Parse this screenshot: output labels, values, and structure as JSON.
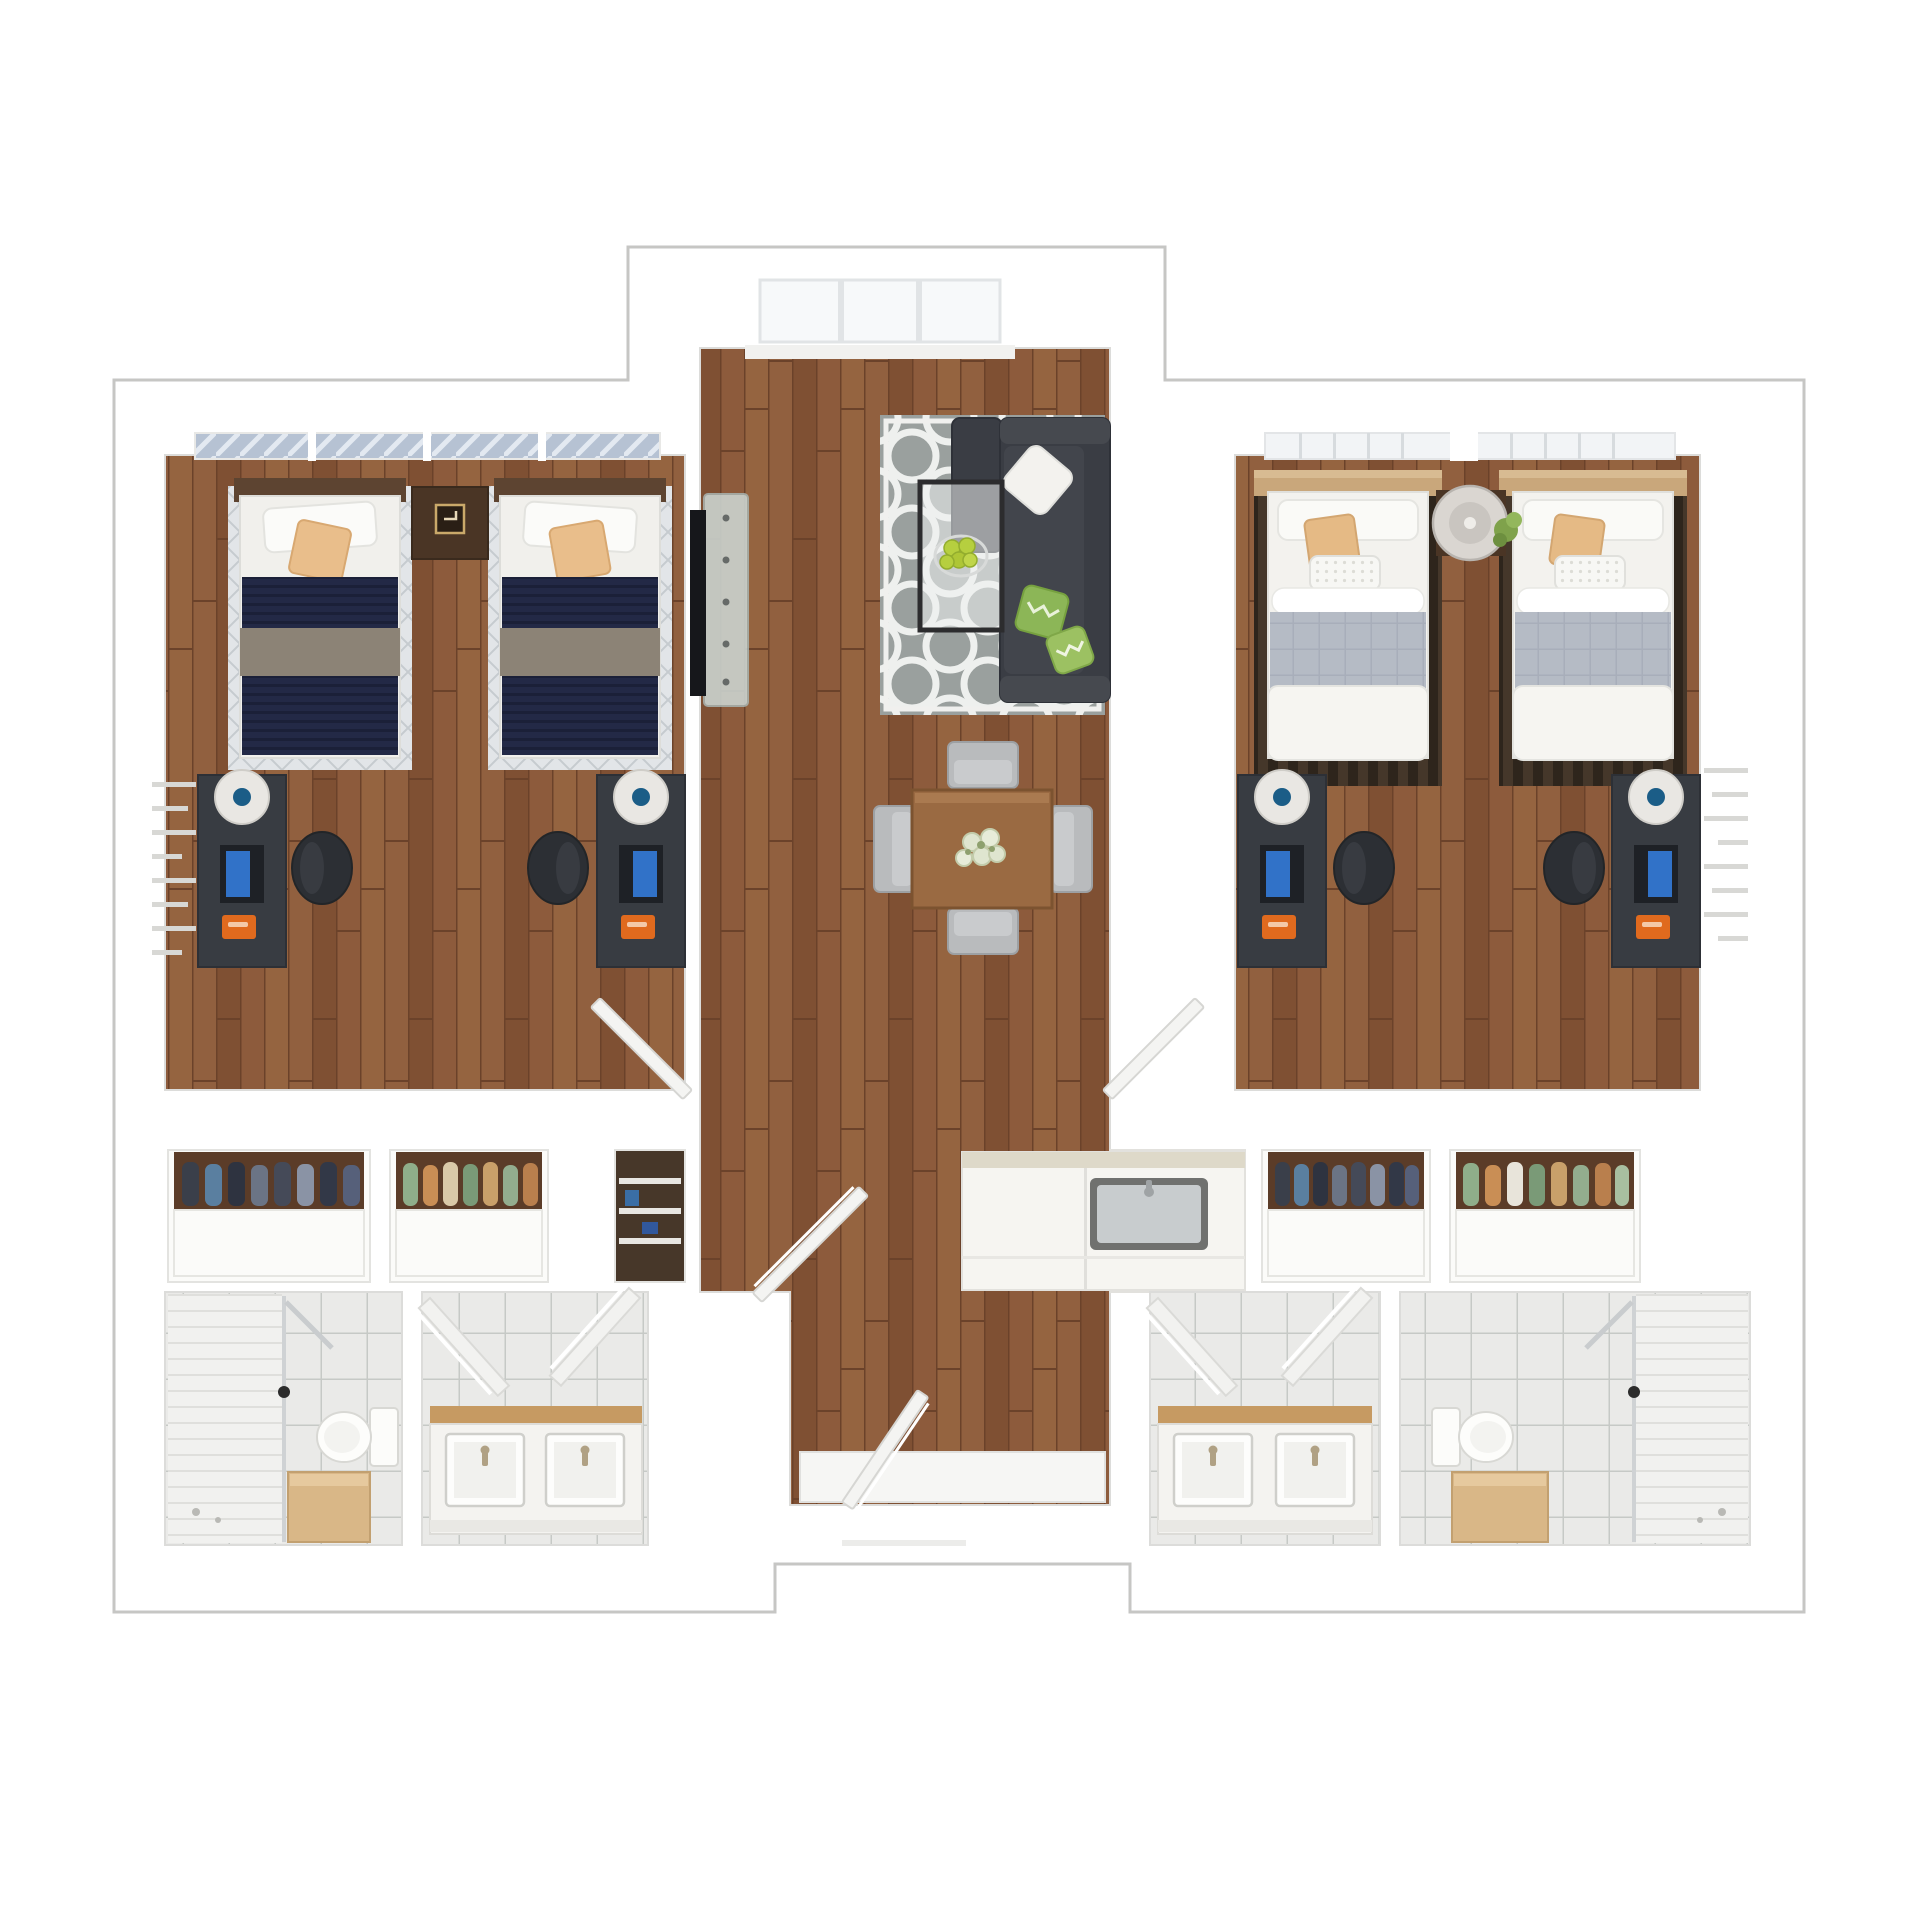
{
  "scene": {
    "kind": "3d-rendered-floorplan-top-view",
    "description": "Two-bedroom residence suite floor plan, rendered in 3D top-down view, no text labels",
    "background": "#ffffff",
    "outline_color": "#c6c6c4"
  },
  "palette": {
    "wall_white": "#ffffff",
    "wood_floor": "#8a573a",
    "wood_floor_dark_line": "#6b422a",
    "tile_floor": "#eaeae8",
    "tile_grout": "#c6c9c6",
    "rug_gray": "#9aa09e",
    "rug_trellis_white": "#eef0ee",
    "sofa_charcoal": "#3a3d44",
    "pillow_green": "#8cb657",
    "pillow_tan": "#e9be8b",
    "blanket_navy": "#232946",
    "blanket_taupe": "#8c8376",
    "blanket_gray": "#b5bbc5",
    "headboard_darkwood": "#5d4431",
    "headboard_tan": "#c9a77b",
    "desk_charcoal": "#383c42",
    "desk_lamp_white": "#e9e7e3",
    "monitor_screen_blue": "#3172c8",
    "desk_accent_orange": "#e06a1e",
    "dining_table_wood": "#9a6a42",
    "chair_silver": "#b9bbbd",
    "vanity_counter_wood": "#c69a62",
    "cabinet_tan": "#d9b787",
    "closet_backdrop_wood": "#5b3c28",
    "apples_green": "#b6cf3f",
    "plant_green": "#7fa24b"
  },
  "rooms": [
    {
      "name": "living-room",
      "floor": "wood",
      "furniture": [
        "trellis-area-rug",
        "sectional-sofa",
        "white-throw-pillow",
        "green-chevron-pillows",
        "glass-coffee-table",
        "bowl-of-green-apples",
        "wall-mounted-tv",
        "window"
      ]
    },
    {
      "name": "dining-area",
      "floor": "wood",
      "furniture": [
        "square-dining-table",
        "flower-centerpiece",
        "dining-chair-north",
        "dining-chair-south",
        "dining-chair-west",
        "dining-chair-east"
      ]
    },
    {
      "name": "bedroom-left",
      "floor": "wood",
      "furniture": [
        "window-with-patterned-curtain",
        "twin-bed-navy-1",
        "twin-bed-navy-2",
        "nightstand-with-clock",
        "desk-with-monitor-1",
        "desk-with-monitor-2",
        "desk-lamp-1",
        "desk-lamp-2",
        "desk-chair-1",
        "desk-chair-2",
        "wall-shelf-unit"
      ]
    },
    {
      "name": "bedroom-right",
      "floor": "wood",
      "furniture": [
        "paned-window",
        "twin-bed-light-1",
        "twin-bed-light-2",
        "striped-bed-runners",
        "round-side-table-with-plant",
        "desk-with-monitor-3",
        "desk-with-monitor-4",
        "desk-lamp-3",
        "desk-lamp-4",
        "desk-chair-3",
        "desk-chair-4",
        "wall-shelf-unit"
      ]
    },
    {
      "name": "kitchenette",
      "floor": "white",
      "furniture": [
        "counter-with-sink",
        "faucet"
      ]
    },
    {
      "name": "closet-left-a",
      "floor": "white",
      "furniture": [
        "hanging-clothes-dark-blue-tones",
        "drawer-base"
      ]
    },
    {
      "name": "closet-left-b",
      "floor": "white",
      "furniture": [
        "hanging-clothes-green-orange-tones",
        "drawer-base"
      ]
    },
    {
      "name": "linen-closet",
      "floor": "dark",
      "furniture": [
        "shelves-with-linens"
      ]
    },
    {
      "name": "closet-right-a",
      "floor": "white",
      "furniture": [
        "hanging-clothes-dark-blue-tones",
        "drawer-base"
      ]
    },
    {
      "name": "closet-right-b",
      "floor": "white",
      "furniture": [
        "hanging-clothes-green-orange-tones",
        "drawer-base"
      ]
    },
    {
      "name": "bathroom-left-shower",
      "floor": "tile",
      "furniture": [
        "walk-in-shower",
        "shower-glass-door",
        "toilet",
        "tan-storage-cabinet"
      ]
    },
    {
      "name": "bathroom-left-vanity",
      "floor": "tile",
      "furniture": [
        "double-sink-vanity",
        "wood-countertop",
        "open-door-leaf-left",
        "open-door-leaf-right"
      ]
    },
    {
      "name": "bathroom-right-vanity",
      "floor": "tile",
      "furniture": [
        "double-sink-vanity",
        "wood-countertop",
        "open-door-leaf-left",
        "open-door-leaf-right"
      ]
    },
    {
      "name": "bathroom-right-shower",
      "floor": "tile",
      "furniture": [
        "toilet",
        "tan-storage-cabinet",
        "walk-in-shower",
        "shower-glass-door"
      ]
    },
    {
      "name": "hallway",
      "floor": "wood",
      "furniture": [
        "bedroom-door-left-open",
        "bedroom-door-right-open",
        "corridor-door-open",
        "entry-door-open",
        "entry-landing"
      ]
    }
  ]
}
